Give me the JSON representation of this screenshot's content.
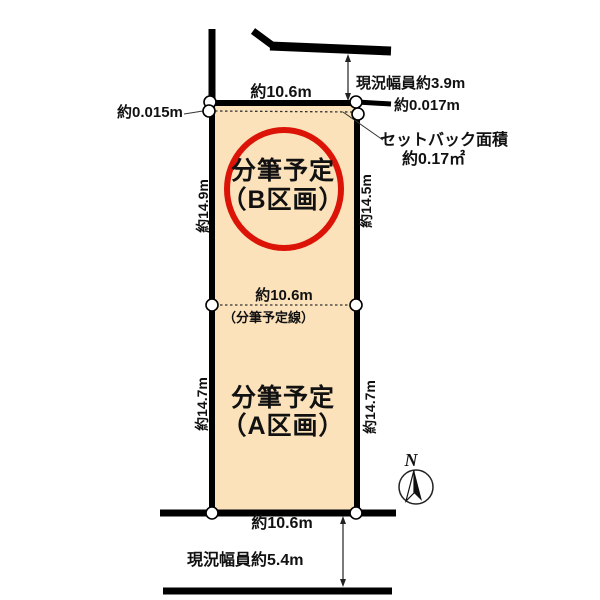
{
  "colors": {
    "plot_fill": "#fbe2bb",
    "outline": "#000000",
    "highlight_red": "#dc1408",
    "background": "#ffffff"
  },
  "parcel": {
    "b": {
      "line1": "分筆予定",
      "line2": "（B区画）",
      "dim_left": "約14.9m",
      "dim_right": "約14.5m",
      "dim_top": "約10.6m"
    },
    "a": {
      "line1": "分筆予定",
      "line2": "（A区画）",
      "dim_left": "約14.7m",
      "dim_right": "約14.7m",
      "dim_bottom": "約10.6m"
    },
    "split": {
      "width": "約10.6m",
      "note": "（分筆予定線）"
    }
  },
  "roads": {
    "top_width": "現況幅員約3.9m",
    "bottom_width": "現況幅員約5.4m"
  },
  "setback": {
    "offset_left": "約0.015m",
    "offset_right": "約0.017m",
    "area_line1": "セットバック面積",
    "area_line2": "約0.17㎡"
  },
  "compass": {
    "north": "N"
  }
}
